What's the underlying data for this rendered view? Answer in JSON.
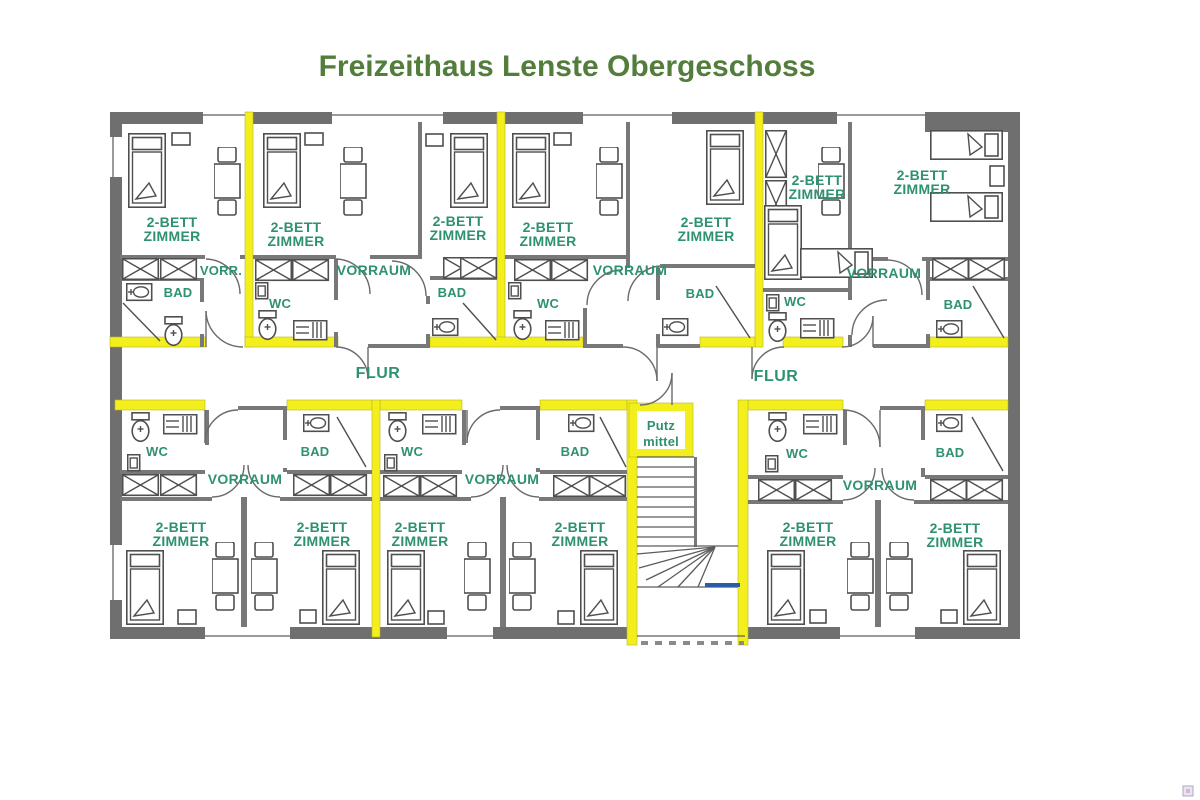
{
  "title": "Freizeithaus Lenste Obergeschoss",
  "labels": {
    "bedroom_line1": "2-BETT",
    "bedroom_line2": "ZIMMER",
    "vorraum": "VORRAUM",
    "vorraum_short": "VORR.",
    "bathroom": "BAD",
    "wc": "WC",
    "corridor": "FLUR",
    "utility_line1": "Putz",
    "utility_line2": "mittel"
  },
  "colors": {
    "wall_gray": "#6f6f6f",
    "highlight_yellow": "#f3ef1c",
    "room_label_green": "#2e9170",
    "title_green": "#527d3b",
    "exit_blue": "#2a5ca8"
  }
}
